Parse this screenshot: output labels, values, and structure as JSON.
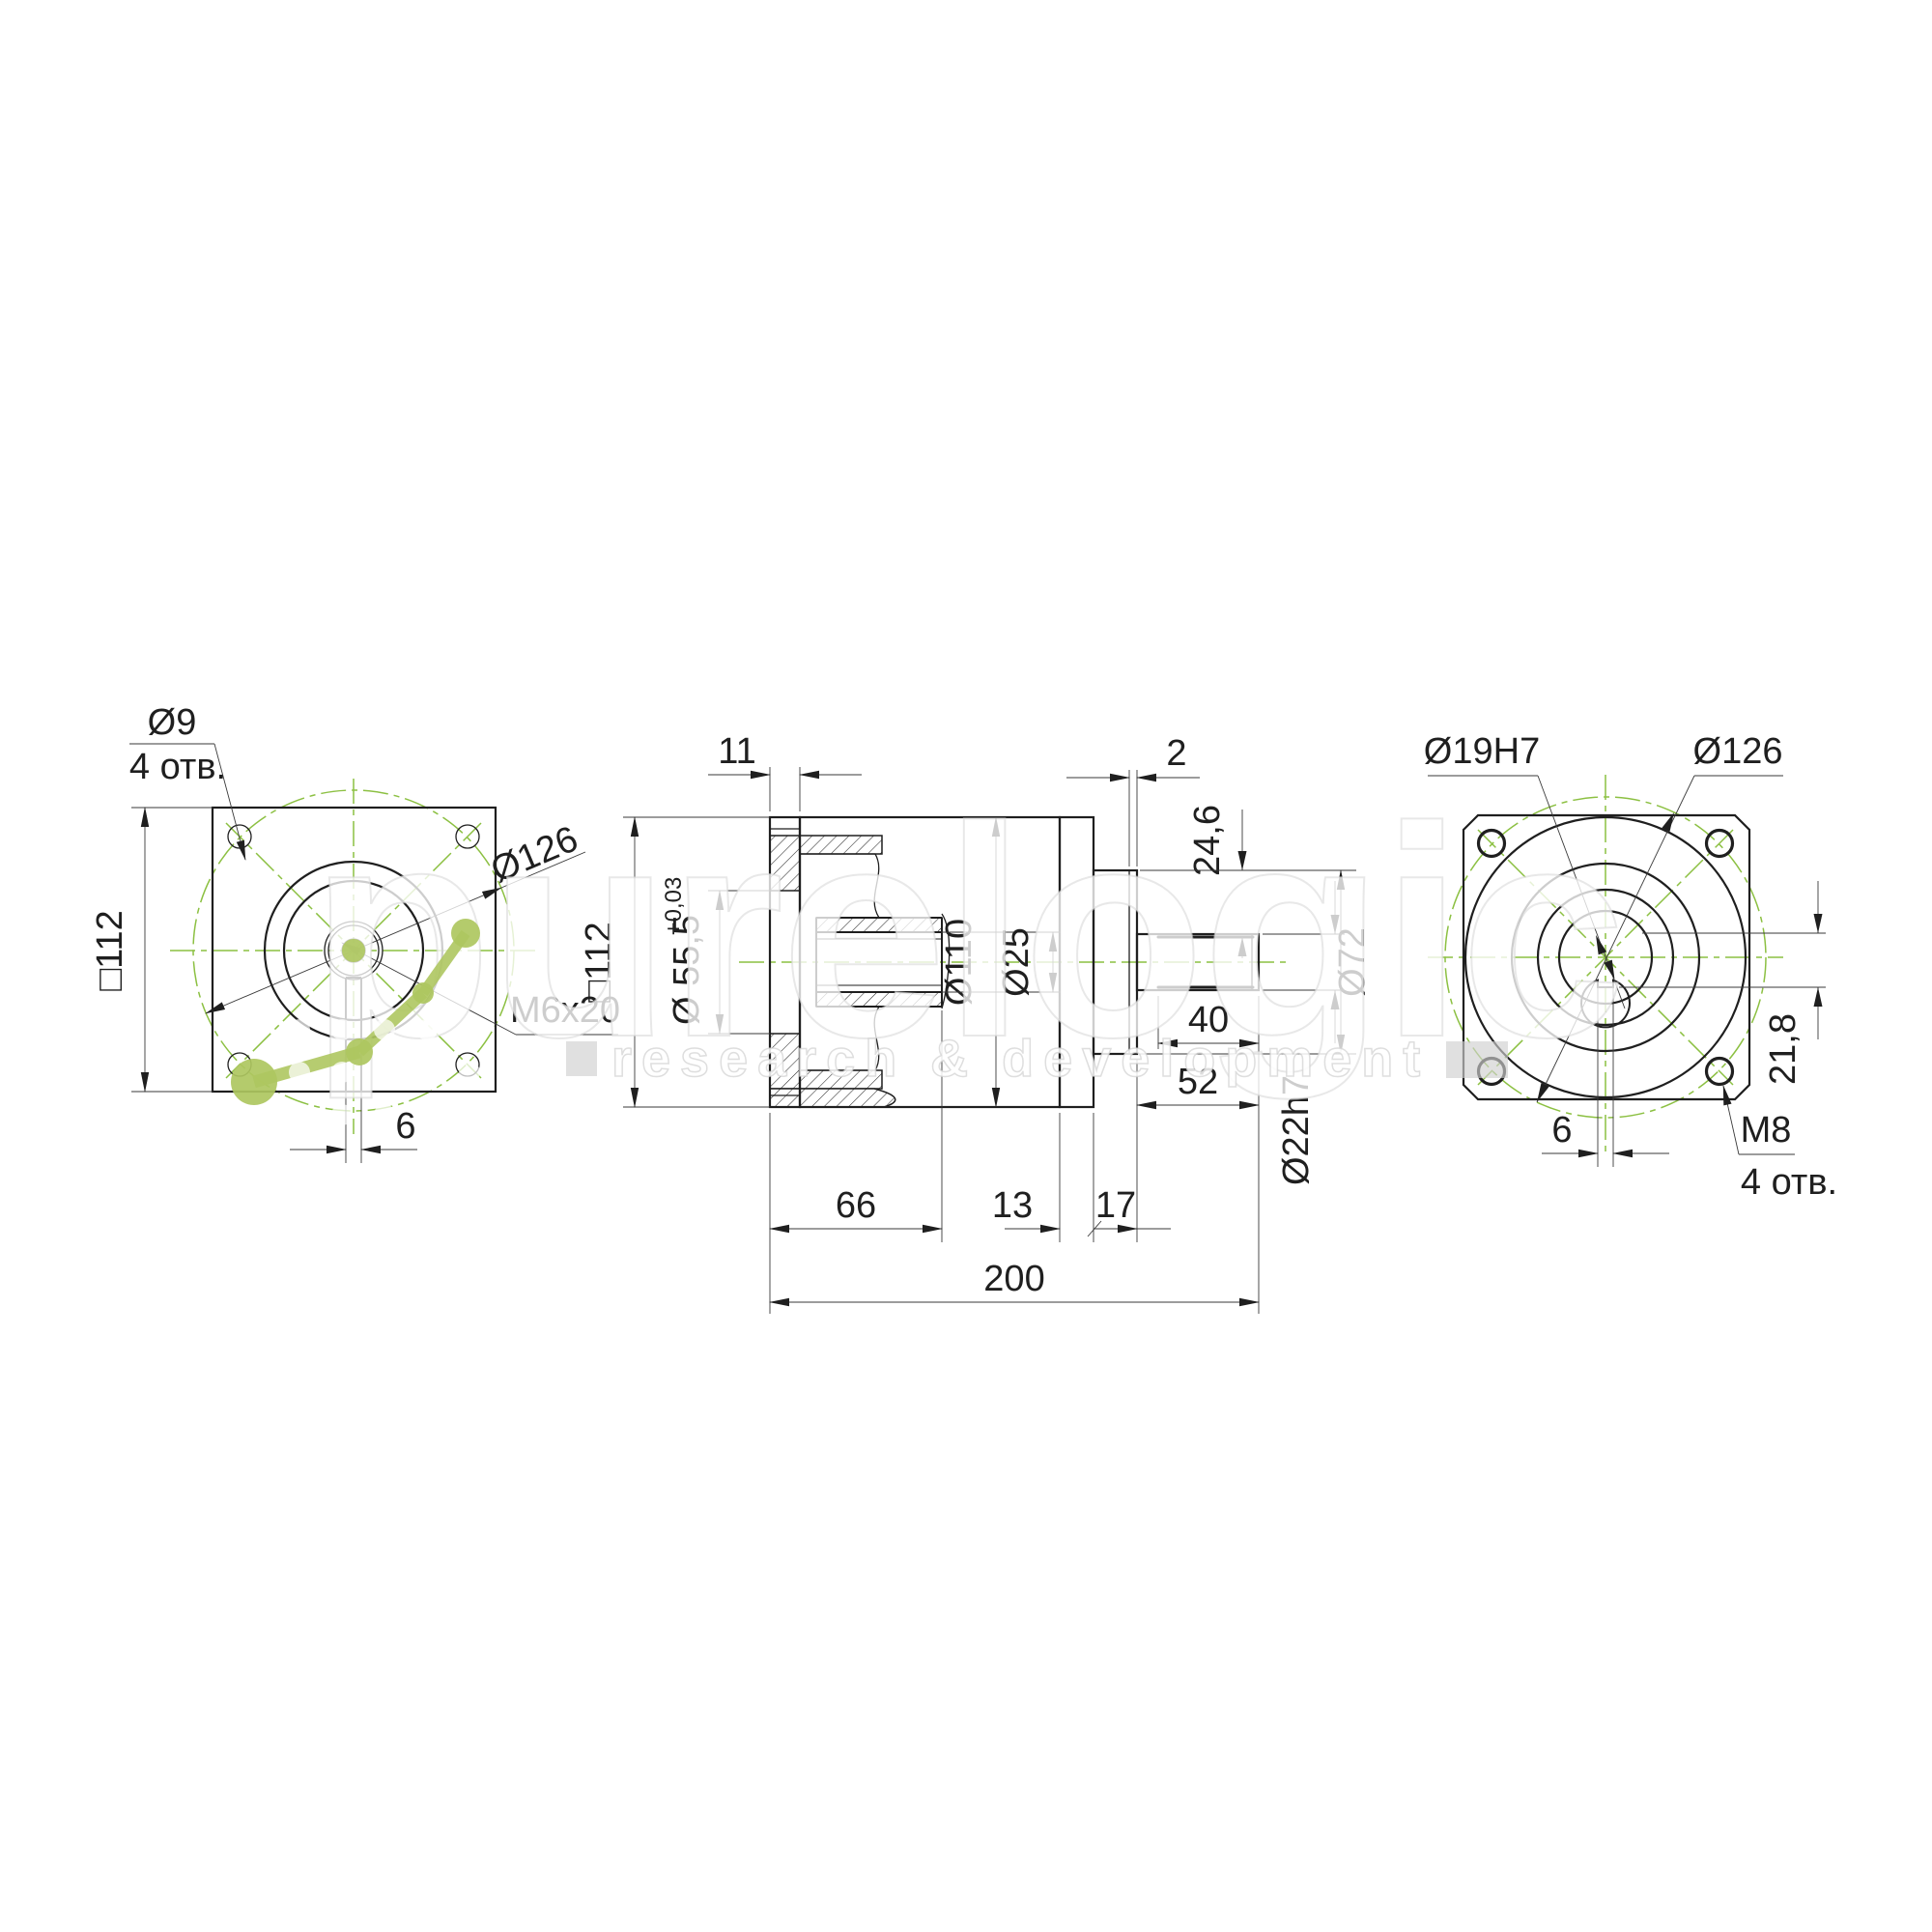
{
  "watermark": {
    "brand": "purelogic",
    "tagline": "research & development",
    "logo_icon": "molecule-icon",
    "brand_color": "#aec760"
  },
  "colors": {
    "line": "#1f1f1f",
    "centerline_green": "#8cc042",
    "dimension": "#3a3a3a",
    "background": "#ffffff"
  },
  "views": {
    "left": {
      "hole_dia": "Ø9",
      "hole_count": "4 отв.",
      "square": "□112",
      "bolt_circle": "Ø126",
      "thread": "M6x20",
      "keyway_width": "6"
    },
    "middle": {
      "flange_thickness": "11",
      "square": "□112",
      "pilot_dia": "Ø 55,5",
      "pilot_tol": "+0,03",
      "body_dia": "Ø110",
      "bore_dia": "Ø25",
      "step": "2",
      "keyway_height": "24,6",
      "boss_dia": "Ø72",
      "keyway_length": "40",
      "shaft_length": "52",
      "shaft_dia": "Ø22h7",
      "len_66": "66",
      "len_13": "13",
      "len_17": "17",
      "total_length": "200"
    },
    "right": {
      "bore_dia": "Ø19H7",
      "bolt_circle": "Ø126",
      "keyway_height": "21,8",
      "thread": "M8",
      "thread_count": "4 отв.",
      "keyway_width": "6"
    }
  }
}
